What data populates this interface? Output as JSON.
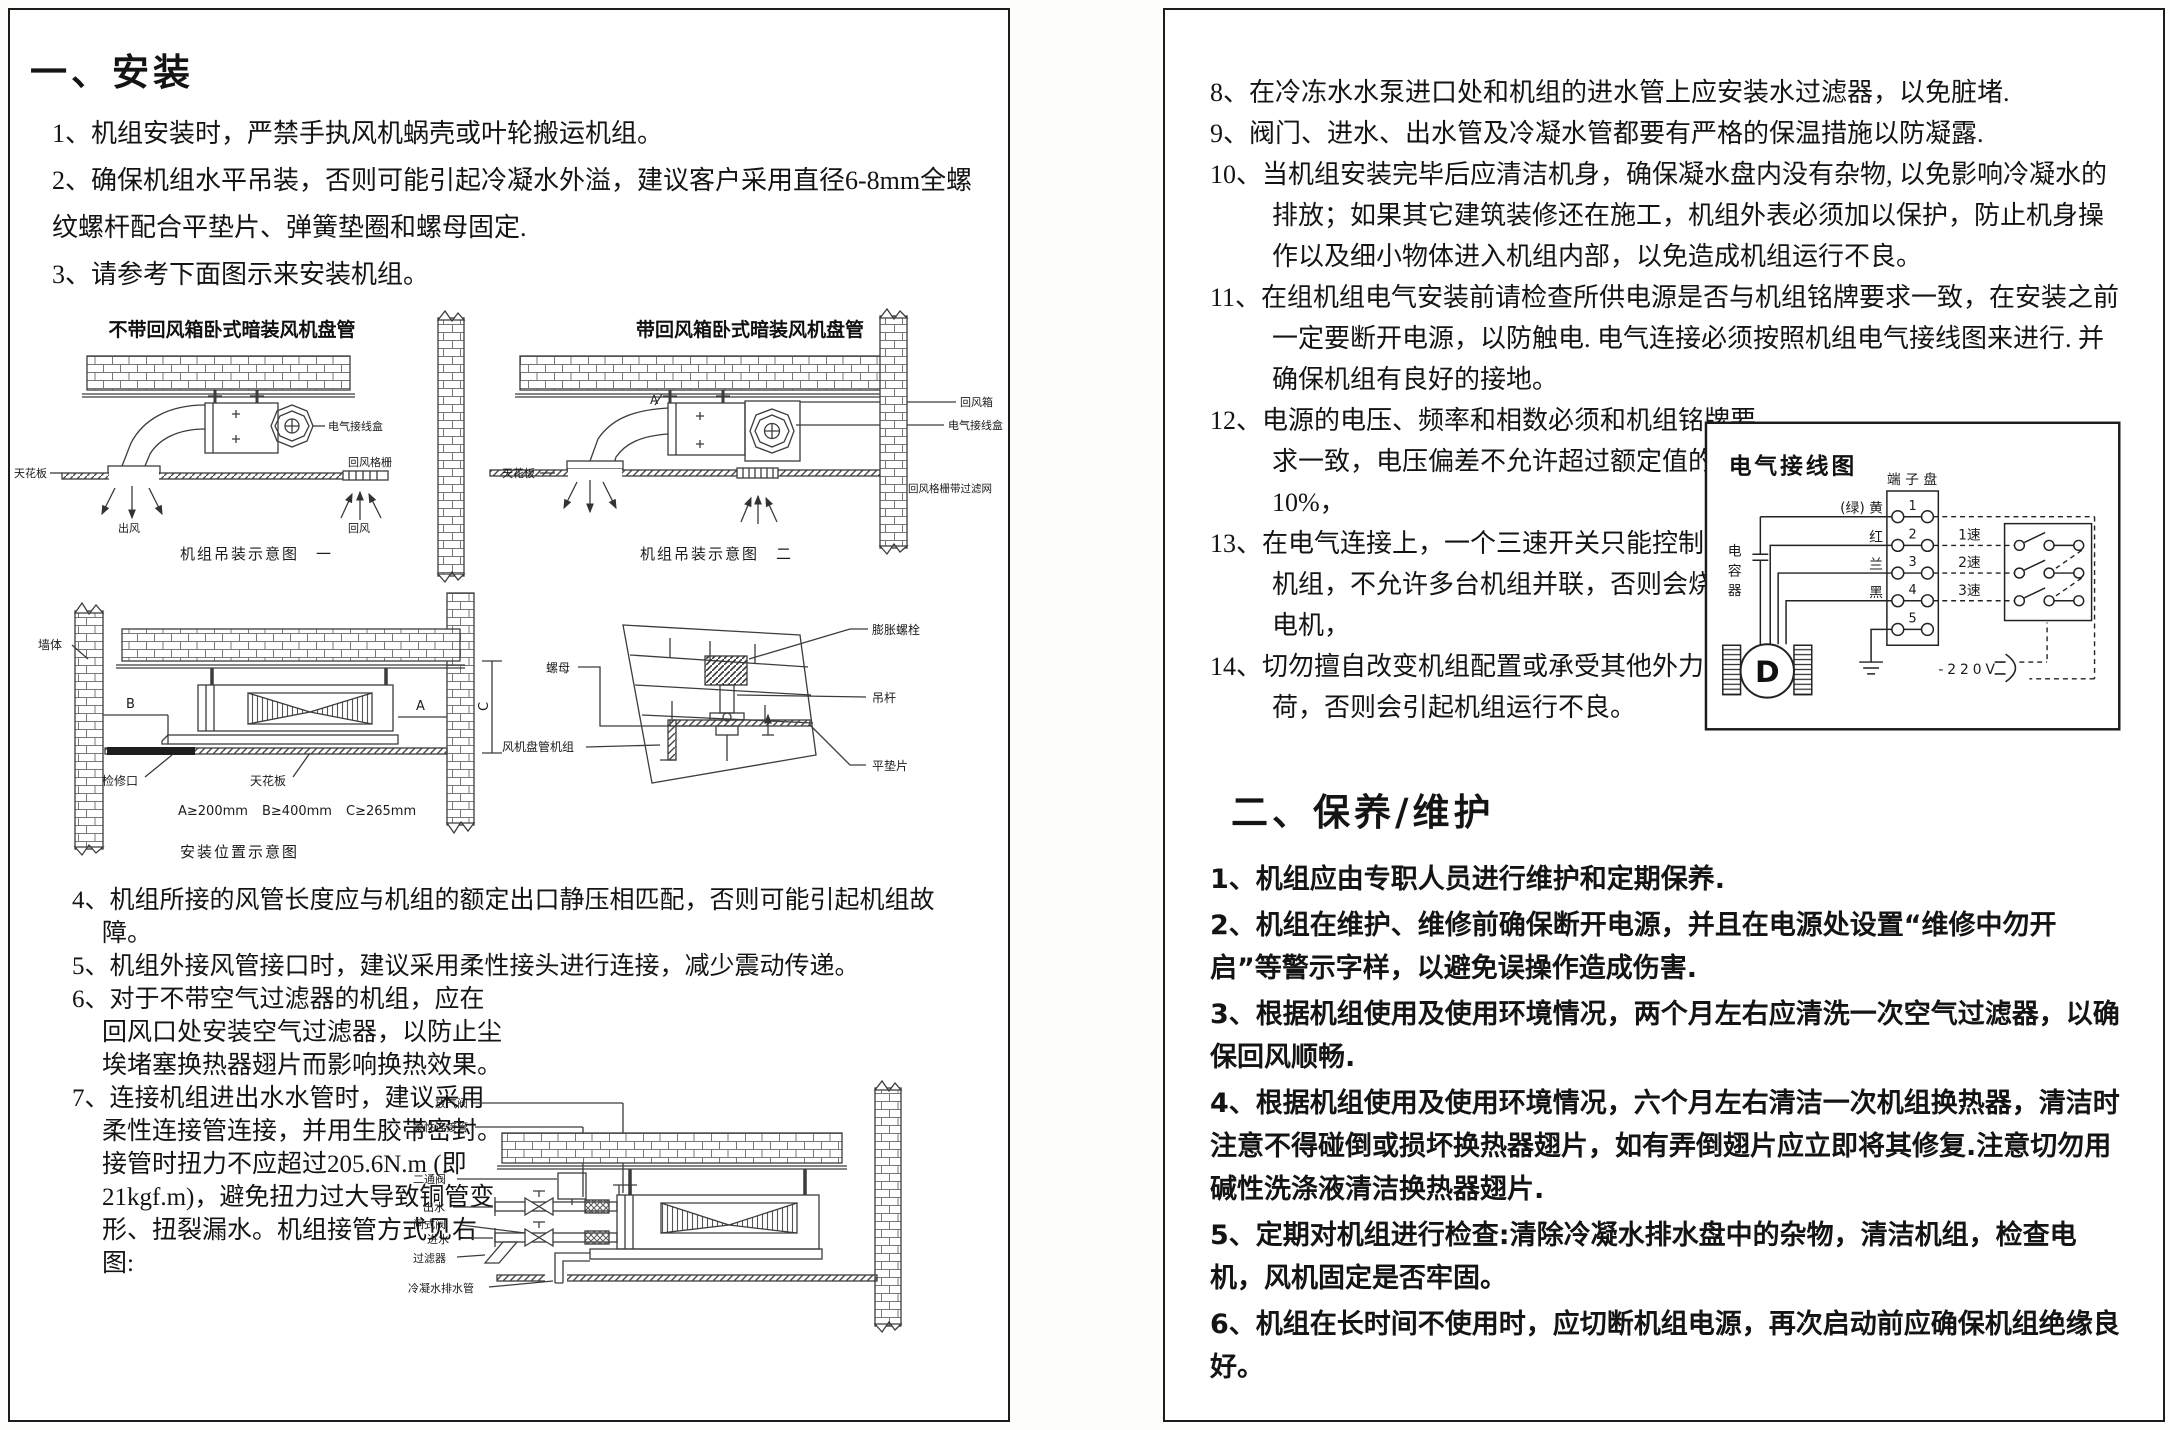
{
  "left": {
    "heading": "一、安装",
    "items": [
      {
        "num": "1、",
        "text": "机组安装时，严禁手执风机蜗壳或叶轮搬运机组。"
      },
      {
        "num": "2、",
        "text": "确保机组水平吊装，否则可能引起冷凝水外溢，建议客户采用直径6-8mm全螺纹螺杆配合平垫片、弹簧垫圈和螺母固定."
      },
      {
        "num": "3、",
        "text": "请参考下面图示来安装机组。"
      }
    ],
    "items2": [
      {
        "num": "4、",
        "text": "机组所接的风管长度应与机组的额定出口静压相匹配，否则可能引起机组故障。"
      },
      {
        "num": "5、",
        "text": "机组外接风管接口时，建议采用柔性接头进行连接，减少震动传递。"
      },
      {
        "num": "6、",
        "text": "对于不带空气过滤器的机组，应在回风口处安装空气过滤器，以防止尘埃堵塞换热器翅片而影响换热效果。"
      },
      {
        "num": "7、",
        "text": "连接机组进出水水管时，建议采用柔性连接管连接，并用生胶带密封。接管时扭力不应超过205.6N.m (即21kgf.m)，避免扭力过大导致铜管变形、扭裂漏水。机组接管方式见右图:"
      }
    ],
    "hang": {
      "title_left": "不带回风箱卧式暗装风机盘管",
      "title_right": "带回风箱卧式暗装风机盘管",
      "caption_left": "机组吊装示意图　一",
      "caption_right": "机组吊装示意图　二",
      "lbl_junction_left": "电气接线盒",
      "lbl_ceiling_left": "天花板",
      "lbl_grille_left": "回风格栅",
      "lbl_supply": "出风",
      "lbl_return": "回风",
      "lbl_a": "A",
      "lbl_return_box": "回风箱",
      "lbl_junction_right": "电气接线盒",
      "lbl_ceiling_right": "天花板",
      "lbl_grille_filter": "回风格栅带过滤网"
    },
    "pos": {
      "lbl_wall": "墙体",
      "lbl_b": "B",
      "lbl_a": "A",
      "lbl_c": "C",
      "lbl_access": "检修口",
      "lbl_ceiling": "天花板",
      "lbl_nut": "螺母",
      "lbl_anchor": "膨胀螺栓",
      "lbl_rod": "吊杆",
      "lbl_fcu": "风机盘管机组",
      "lbl_washer": "平垫片",
      "dim_a": "A≥200mm",
      "dim_b": "B≥400mm",
      "dim_c": "C≥265mm",
      "caption": "安装位置示意图"
    },
    "pipe": {
      "lbl_air_valve": "放气阀",
      "lbl_flex": "柔性连接管",
      "lbl_two_way": "二通阀",
      "lbl_out": "出水",
      "lbl_gate": "闸式阀",
      "lbl_in": "进水",
      "lbl_strainer": "过滤器",
      "lbl_drain": "冷凝水排水管"
    }
  },
  "right": {
    "items": [
      {
        "num": "8、",
        "text": "在冷冻水水泵进口处和机组的进水管上应安装水过滤器，以免脏堵."
      },
      {
        "num": "9、",
        "text": "阀门、进水、出水管及冷凝水管都要有严格的保温措施以防凝露."
      },
      {
        "num": "10、",
        "text": "当机组安装完毕后应清洁机身，确保凝水盘内没有杂物, 以免影响冷凝水的排放；如果其它建筑装修还在施工，机组外表必须加以保护，防止机身操作以及细小物体进入机组内部，以免造成机组运行不良。"
      },
      {
        "num": "11、",
        "text": "在组机组电气安装前请检查所供电源是否与机组铭牌要求一致，在安装之前一定要断开电源，以防触电. 电气连接必须按照机组电气接线图来进行. 并确保机组有良好的接地。"
      },
      {
        "num": "12、",
        "text": "电源的电压、频率和相数必须和机组铭牌要求一致，电压偏差不允许超过额定值的 ± 10%，"
      },
      {
        "num": "13、",
        "text": "在电气连接上，一个三速开关只能控制一台机组，不允许多台机组并联，否则会烧坏毁电机，"
      },
      {
        "num": "14、",
        "text": "切勿擅自改变机组配置或承受其他外力载荷，否则会引起机组运行不良。"
      }
    ],
    "wiring": {
      "title": "电气接线图",
      "terminal": "端 子 盘",
      "wires": [
        "(绿) 黄",
        "红",
        "兰",
        "黑"
      ],
      "terminals": [
        "1",
        "2",
        "3",
        "4",
        "5"
      ],
      "speeds": [
        "1速",
        "2速",
        "3速"
      ],
      "capacitor": "电容器",
      "motor": "D",
      "voltage": "-220V"
    },
    "maint_heading": "二、保养/维护",
    "maint_items": [
      {
        "num": "1、",
        "text": "机组应由专职人员进行维护和定期保养."
      },
      {
        "num": "2、",
        "text": "机组在维护、维修前确保断开电源，并且在电源处设置“维修中勿开启”等警示字样，以避免误操作造成伤害."
      },
      {
        "num": "3、",
        "text": "根据机组使用及使用环境情况，两个月左右应清洗一次空气过滤器，以确保回风顺畅."
      },
      {
        "num": "4、",
        "text": "根据机组使用及使用环境情况，六个月左右清洁一次机组换热器，清洁时注意不得碰倒或损坏换热器翅片，如有弄倒翅片应立即将其修复.注意切勿用碱性洗涤液清洁换热器翅片."
      },
      {
        "num": "5、",
        "text": "定期对机组进行检查:清除冷凝水排水盘中的杂物，清洁机组，检查电机，风机固定是否牢固。"
      },
      {
        "num": "6、",
        "text": "机组在长时间不使用时，应切断机组电源，再次启动前应确保机组绝缘良好。"
      }
    ]
  }
}
